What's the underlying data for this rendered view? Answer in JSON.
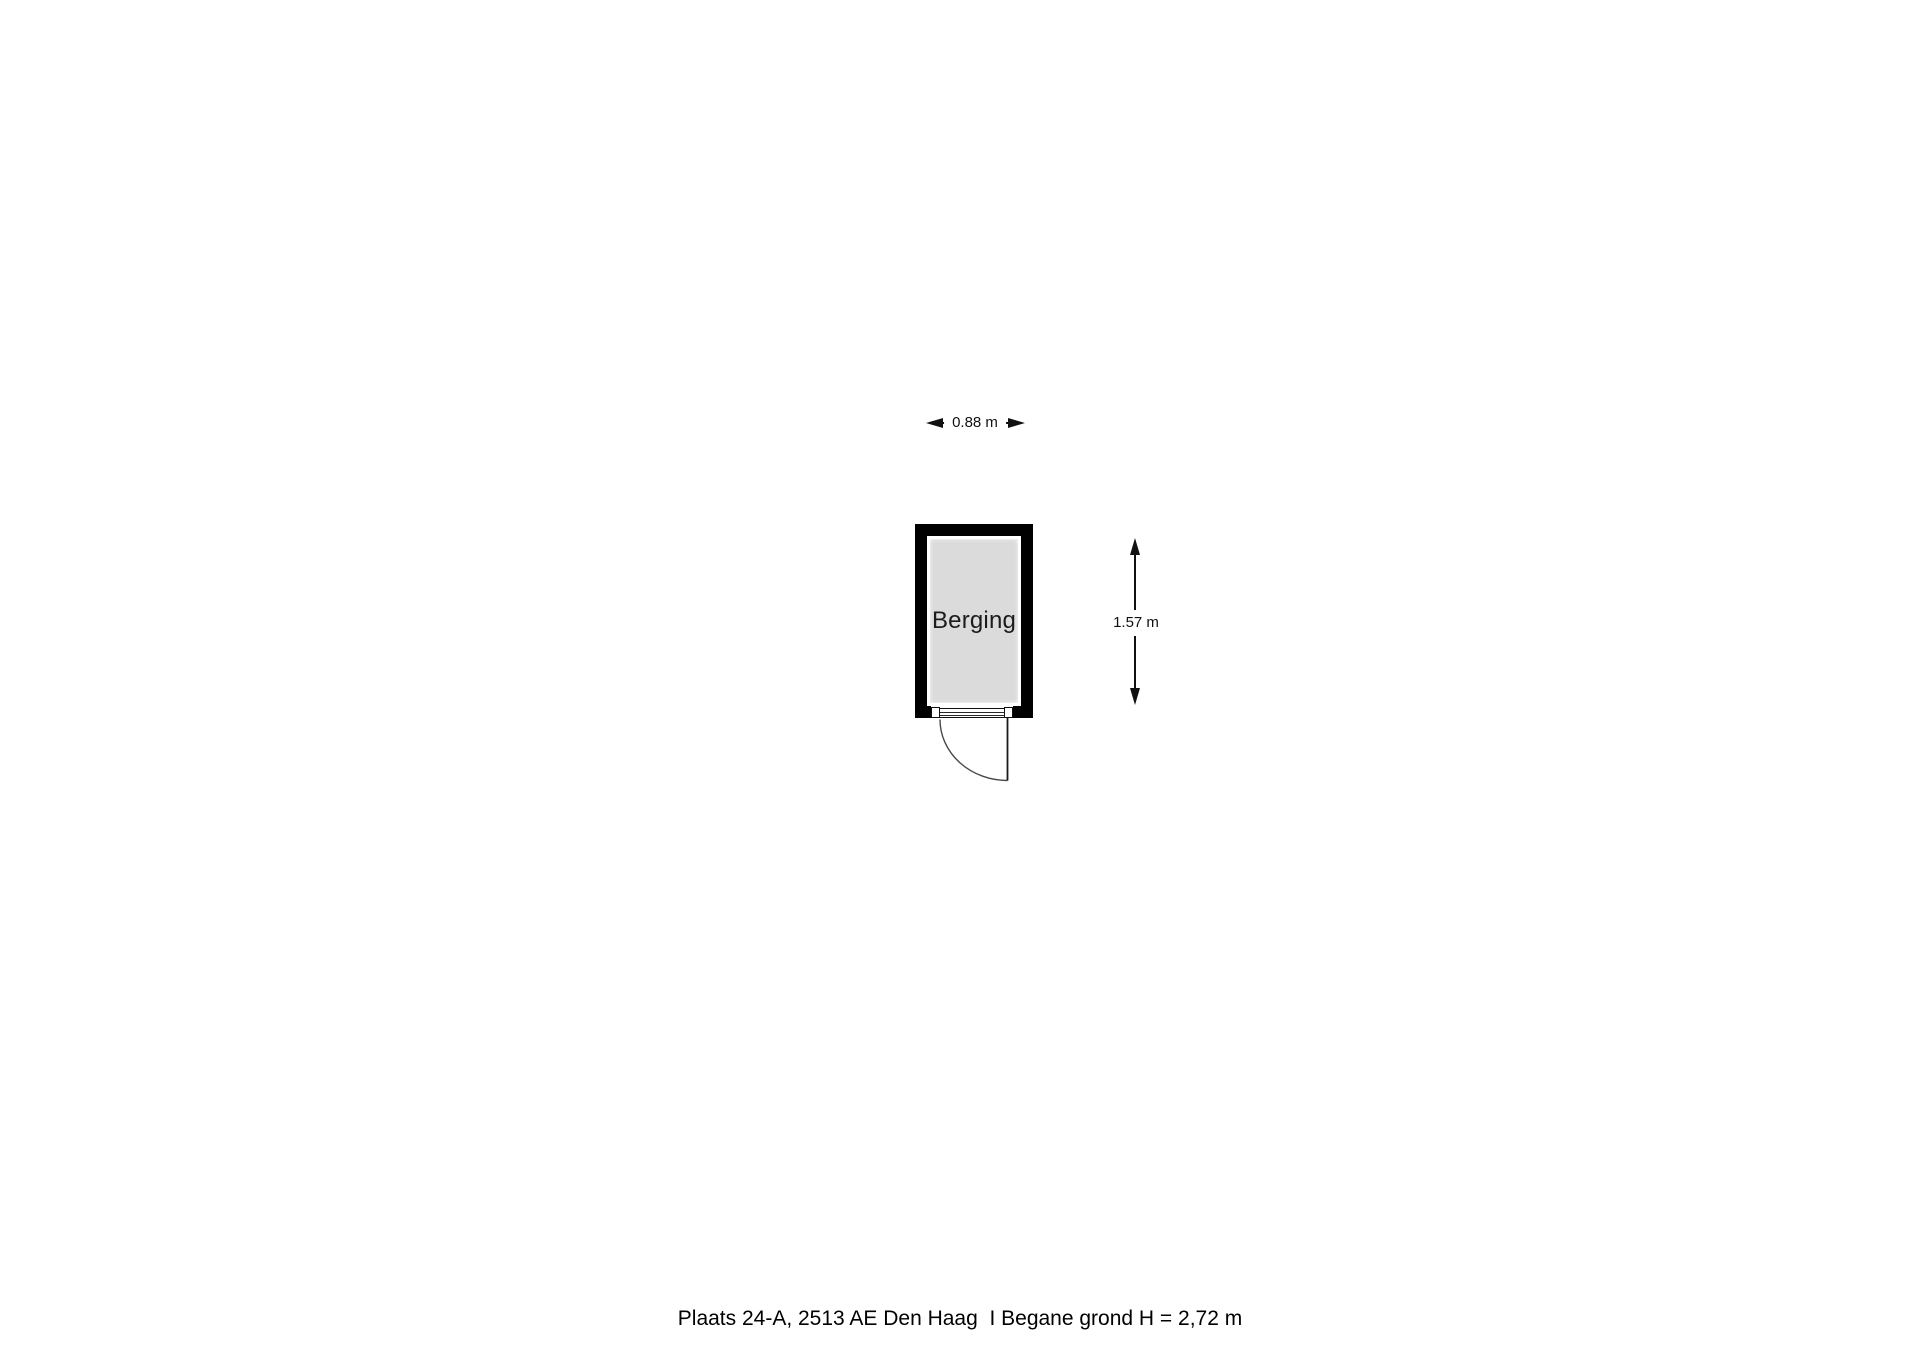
{
  "floorplan": {
    "room": {
      "label": "Berging",
      "wall_color": "#000000",
      "floor_fill": "#dbdbdb"
    },
    "dimensions": {
      "width_label": "0.88 m",
      "height_label": "1.57 m"
    },
    "door": {
      "type": "single-swing",
      "position": "bottom-wall"
    }
  },
  "footer": {
    "caption": "Plaats 24-A, 2513 AE Den Haag  I Begane grond H = 2,72 m"
  },
  "colors": {
    "background": "#ffffff",
    "line": "#111111"
  }
}
